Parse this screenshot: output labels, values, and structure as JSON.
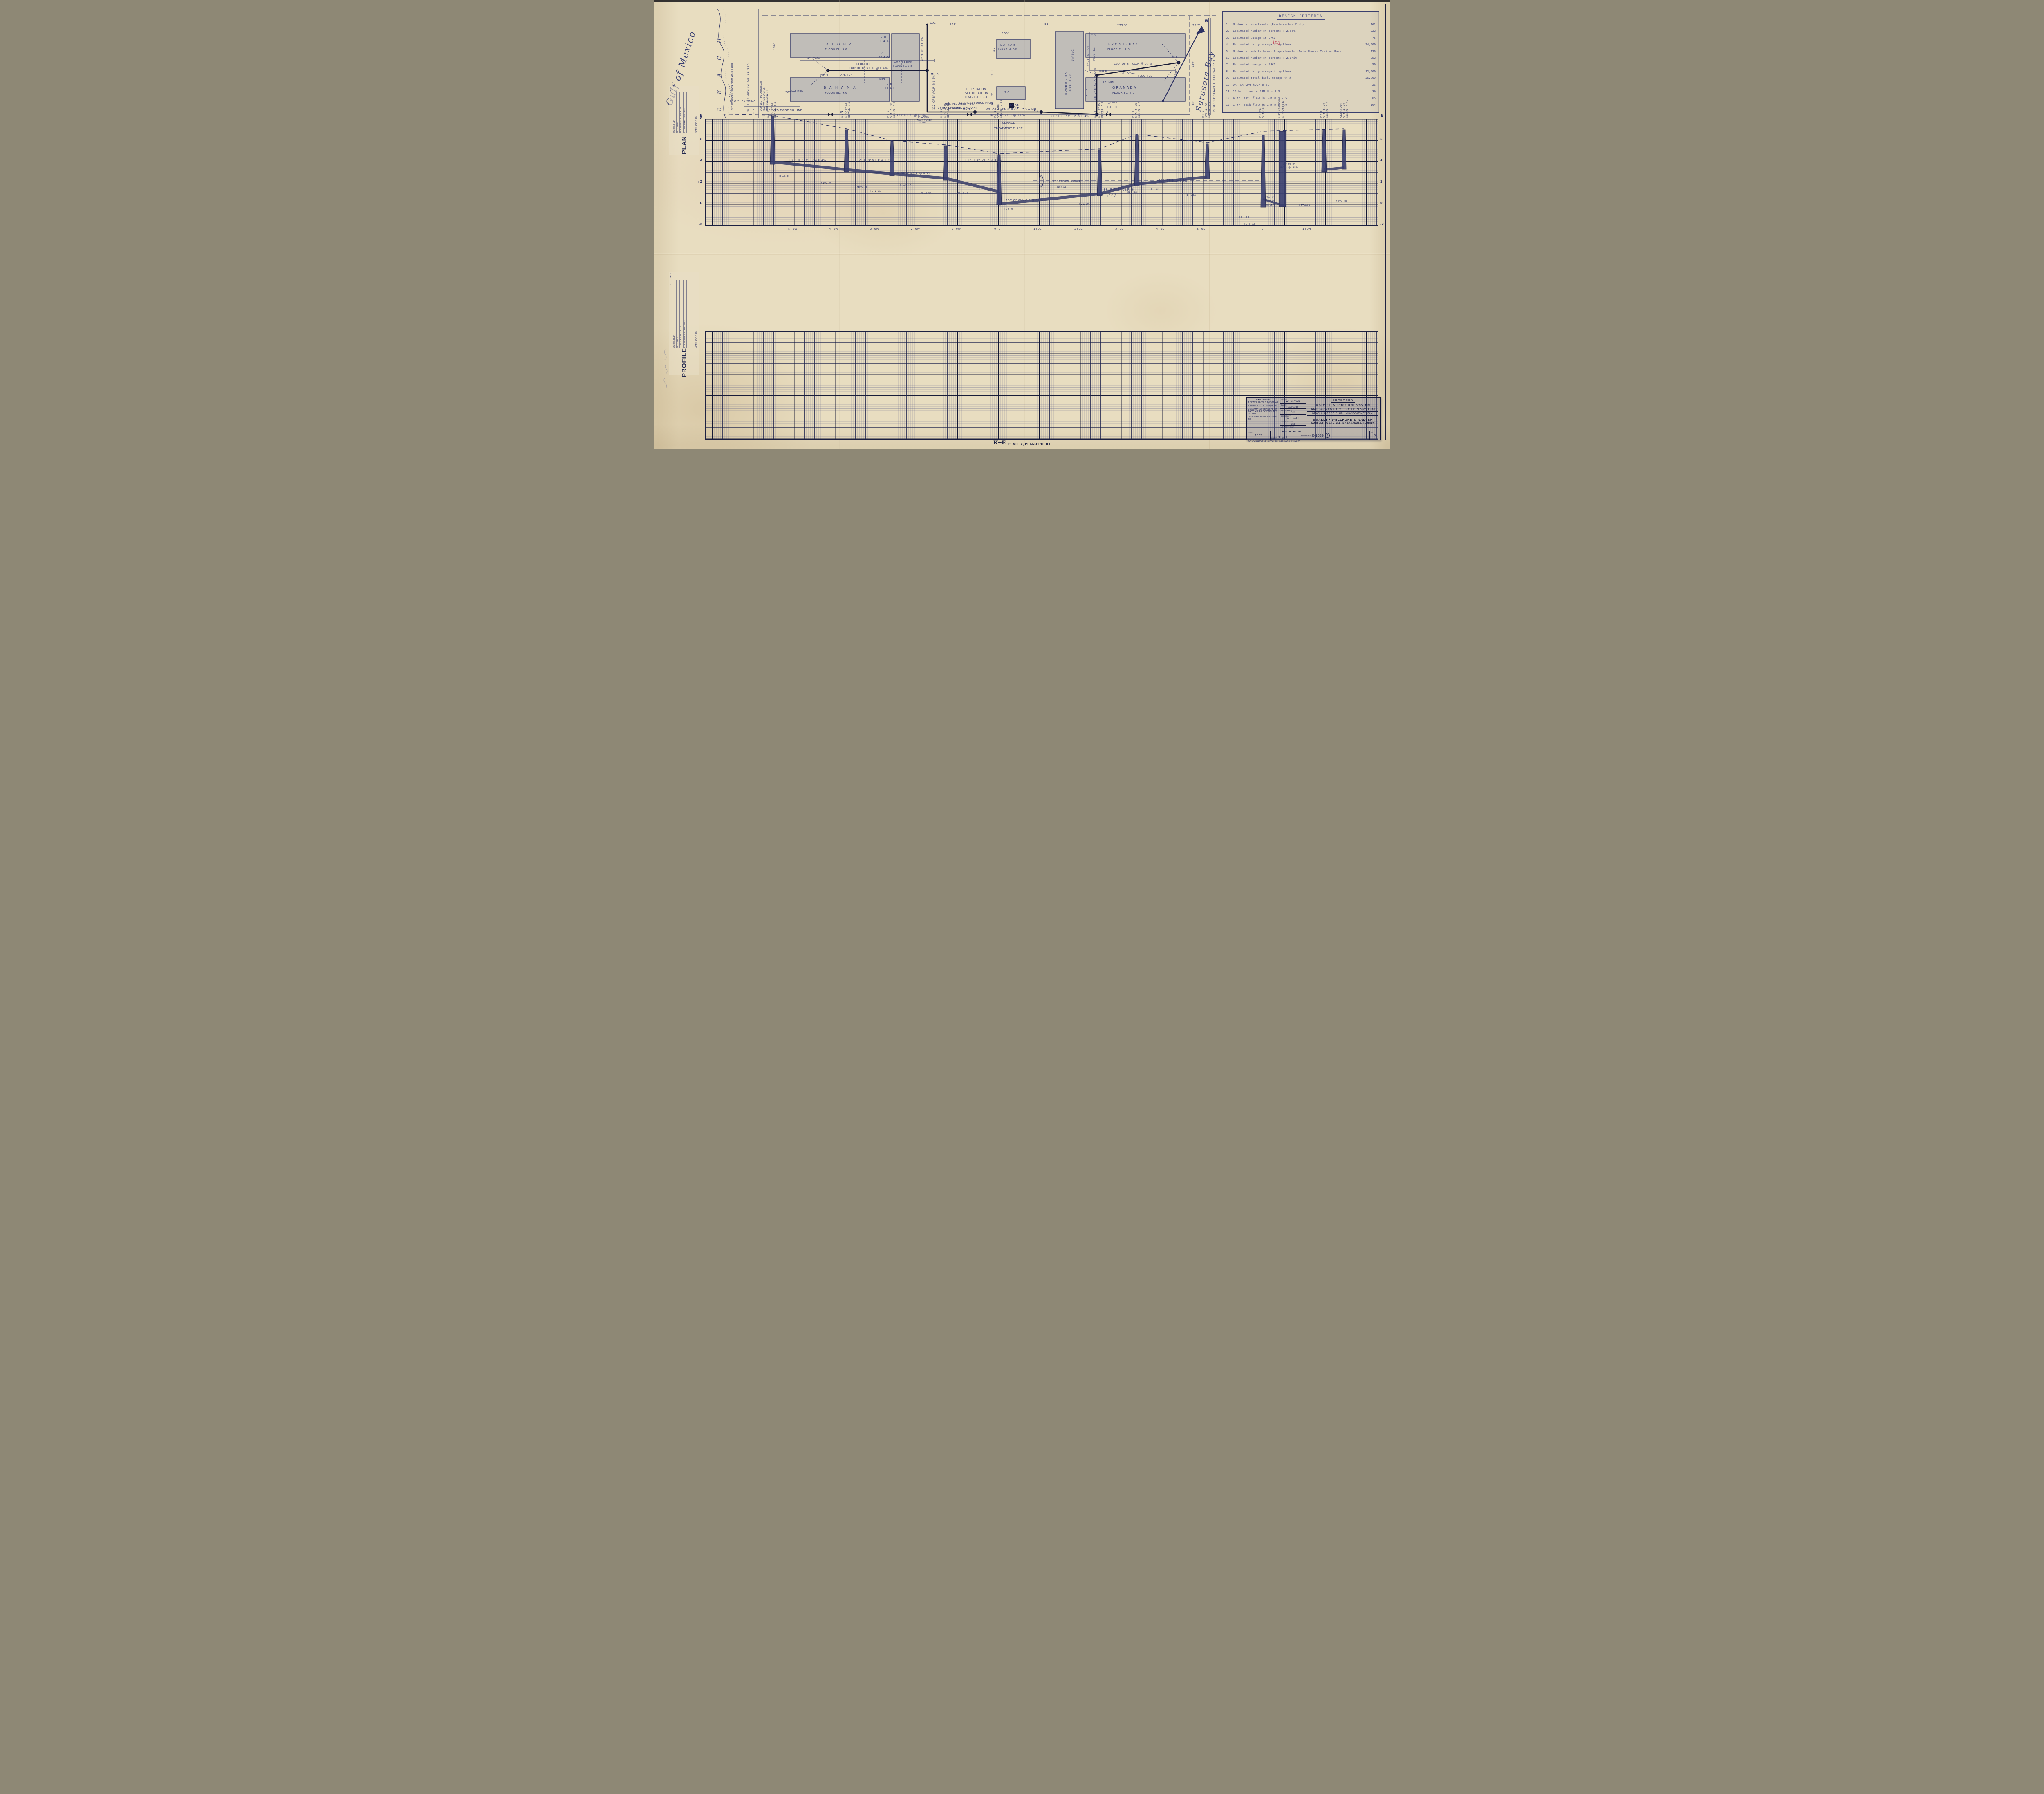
{
  "criteria": {
    "title": "DESIGN CRITERIA",
    "items": [
      {
        "no": "1.",
        "label": "Number of apartments (Beach-Harbor Club)",
        "dash": "—",
        "value": "161"
      },
      {
        "no": "2.",
        "label": "Estimated number of persons @ 2/apt.",
        "dash": "—",
        "value": "322"
      },
      {
        "no": "3.",
        "label": "Estimated useage in GPCD",
        "dash": "—",
        "value": "75"
      },
      {
        "no": "4.",
        "label": "Estimated daily useage in gallons",
        "dash": "—",
        "value": "24,200"
      },
      {
        "no": "5.",
        "label": "Number of mobile homes & apartments (Twin Shores Trailer Park)",
        "dash": "—",
        "value": "126"
      },
      {
        "no": "6.",
        "label": "Estimated number of persons @ 2/unit",
        "value": "252"
      },
      {
        "no": "7.",
        "label": "Estimated useage in GPCD",
        "value": "50"
      },
      {
        "no": "8.",
        "label": "Estimated daily useage in gallons",
        "value": "12,600"
      },
      {
        "no": "9.",
        "label": "Estimated total daily useage ④+⑧",
        "value": "36,800"
      },
      {
        "no": "10.",
        "label": "DAF in GPM ⑧/24 x 60",
        "value": "26"
      },
      {
        "no": "11.",
        "label": "16 hr. flow in GPM ⑩ x 1.5",
        "value": "39"
      },
      {
        "no": "12.",
        "label": "4 hr. max. flow in GPM ⑩ x 2.5",
        "value": "65"
      },
      {
        "no": "13.",
        "label": "1 hr. peak flow in GPM ⑩ x 4.0",
        "value": "104"
      }
    ],
    "red_note": "108"
  },
  "plan": {
    "labels": {
      "gulf": "Gulf of Mexico",
      "beach": "B E A C H",
      "hwl": "APPROXIMATE MEAN HIGH WATER LINE",
      "road_cl": "GULF OF MEXICO DR.   SR 780",
      "connect1": "CONNECT TO LONGBOAT",
      "connect2": "KEY WATER SYSTEM",
      "connect3": "WHEN AVAILABLE",
      "gs2": "2\" G.S. EXISTING",
      "tie": "TIE INTO EXISTING LINE",
      "d30": "30'",
      "d19": "19.5'",
      "d150w": "150'",
      "d226": "226.17'",
      "d44": "44'",
      "d153": "153'",
      "d88": "88'",
      "d100": "100'",
      "d50": "50'",
      "d71": "71.17",
      "d20": "20'",
      "d9": "9'",
      "d279": "279.5'",
      "d25": "25.5'",
      "d150e": "150'",
      "d45": "45'",
      "aloha": "A L O H A",
      "aloha_fl": "FLOOR EL. 9.0",
      "bahama": "B A H A M A",
      "bahama_fl": "FLOOR EL. 9.0",
      "carib": "CARIBBEAN",
      "carib_fl": "FLOOR EL. 7.5",
      "dakar": "DA KAR",
      "dakar_fl": "FLOOR EL 7.0",
      "edge": "EDGEWATER",
      "edge_fl": "FLOOR EL 7.0",
      "front": "FRONTENAC",
      "front_fl": "FLOOR EL. 7.0",
      "gran": "GRANADA",
      "gran_fl": "FLOOR EL. 7.0",
      "small70": "7.0",
      "pvc3a": "3\" P.V.C.",
      "mh4": "MH 4",
      "plugtee1": "PLUG TEE",
      "seg180": "180' OF 8\" V.C.P. @ 0.4%",
      "mh3": "MH 3",
      "co1": "C.O.",
      "seg50co": "50' OF 8\" @ 0.4%",
      "seg112": "112' OF 8\" V.C.P. @ 0.3%",
      "red32": "3X2 RED.",
      "ac6a": "6\" A.C.",
      "min7a": "7'±",
      "fe412": "FE 4.12",
      "min7b": "7'±",
      "fe406": "FE 4.06",
      "minlbl": "MIN.",
      "min7c": "7'±",
      "fe410": "FE 4.10",
      "lift1": "LIFT STATION",
      "lift2": "SEE DETAIL ON",
      "lift3": "DWG E-1039-10",
      "fm65": "65' OF 3\" FORCE MAIN",
      "reducer": "(1) 4\"X3\" REDUCER",
      "mh1a": "MH 1A",
      "fm65b": "65' OF 4\" F.M.",
      "mh1": "MH 1",
      "seg130b": "130' OF 8\" V.C.P @ 1.0%",
      "seg130a": "130' OF 8\" @ 0.3%",
      "pvc15": "1½\" PVC",
      "vc6": "6\" V.C. @ 1.5%",
      "co2": "C.O.",
      "tee_plug1": "TEE, PLUGGED FOR",
      "tee_plug2": "FUTURE FIRE HYDRANT",
      "acor": "AC OR",
      "pvc4": "4\" P.V.C.",
      "seg250": "250' OF 8\" V.C.P. @ 0.4%",
      "mh5": "MH 5",
      "tee6": "6\" TEE",
      "future": "FUTURE",
      "mh6": "MH 6",
      "seg88": "88' OF 8\" C.I.P. @ 0.4%",
      "ci4": "4\" C.I.",
      "min10": "10' MIN.",
      "pvc3b": "3\" P.V.C.",
      "plugtee2": "PLUG TEE",
      "mh7": "MH 7",
      "seg150": "150' OF 8\" V.C.P. @ 0.4%",
      "plugtee3": "PLUG TEE",
      "pvc3c": "3\" P.V.C.",
      "seawall": "PROPOSED SEAWALL @ ELEVATION 4.0",
      "sarasota": "Sarasota Bay",
      "scale50": "1\"=50'",
      "north": "N"
    }
  },
  "profile": {
    "match_left": "B",
    "match_right": "B",
    "left_axis": [
      "8",
      "6",
      "4",
      "+2",
      "0",
      "-2"
    ],
    "right_axis": [
      "6",
      "4",
      "2",
      "0",
      "-2"
    ],
    "stations": [
      "5+0W",
      "4+0W",
      "3+0W",
      "2+0W",
      "1+0W",
      "0+0",
      "1+0E",
      "2+0E",
      "3+0E",
      "4+0E",
      "5+0E",
      "0",
      "1+0N"
    ],
    "manholes": [
      {
        "id": "MH 4",
        "sta": "STA. 5+52",
        "rim": "RIM EL. 8.3"
      },
      {
        "id": "MH 3",
        "sta": "STA. 3+72",
        "rim": "RIM EL. 7.0"
      },
      {
        "id": "MH 2",
        "sta": "STA. 2+60",
        "rim": "RIM EL. 5.9"
      },
      {
        "id": "MH 1A",
        "sta": "STA. 1+30",
        "rim": "RIM EL. 5.5"
      },
      {
        "id": "MH 1",
        "sta": "STA. 0.00",
        "rim": "RIM EL. 4.65"
      },
      {
        "id": "MH 5",
        "sta": "STA. 2+50 E",
        "rim": "RIM EL. 5.1"
      },
      {
        "id": "MH 6",
        "sta": "STA. 3+38",
        "rim": "RIM EL. 6.5"
      },
      {
        "id": "MH 7",
        "sta": "STA. 4+88",
        "rim": "RIM EL. 5.7"
      },
      {
        "id": "MH #1",
        "sta": "STA 0+00",
        "rim": ""
      },
      {
        "id": "LIFT STATION",
        "sta": "STA 0+50 N",
        "rim": ""
      },
      {
        "id": "MH 3",
        "sta": "STA. 3+72",
        "rim": "RIM EL. 7.0"
      },
      {
        "id": "CLEANOUT",
        "sta": "STA. 4+22",
        "rim": "RIM EL. 7.0±"
      }
    ],
    "segments": {
      "s180": "180' OF 8\" V.C.P @ 0.4%",
      "s112": "112' OF 8\" V.C.P @ 0.3%",
      "s130a": "130' OF 8\" V.C.P. @ 0.3%",
      "s130b": "130' OF 8\" V.C.P. @ 1.0%",
      "s250": "250' OF 8\" V.C.P. @ 0.4%",
      "s88a": "88 LF OF 8\" C.I.P. @",
      "s88b": "0.4%",
      "s150": "150' OF 8\" @ 0.4%",
      "storm": "10\" STORM SEWER",
      "s50a": "50 LF.",
      "s50b": "8\"VCP",
      "s50c": "@ .8%",
      "pcp1": "50' OF 8\"",
      "pcp2": "P.C.P. @ .85%"
    },
    "inverts": {
      "fe402": "FE=4.02",
      "fe330": "FE=3.30",
      "fe328": "FE=3.28",
      "fe291": "FE=2.91",
      "fe287": "FE=2.87",
      "fe250": "FE=2.50",
      "fe247": "FE=2.47",
      "fe114": "FE 1.14",
      "fe000": "FE 0.00",
      "fe100": "FE 1.00",
      "fe151": "FE 1.51",
      "fe186": "FE 1.86",
      "fe196": "FE 1.96",
      "fe256": "FE=2.56",
      "fe205": "FE 2.05",
      "feneg": "FE(-)0.1",
      "fepos": "FE(+)0.5",
      "fe328n": "FE=3.28",
      "fe348n": "FE=3.48"
    },
    "stp1": "SEWAGE",
    "stp2": "TREATMENT PLANT",
    "wp1": "3\" WATER",
    "wp2": "FROM WATER",
    "wp3": "PLANT"
  },
  "margin": {
    "plan": {
      "title": "PLAN",
      "by": "BY",
      "date": "DATE",
      "rows": [
        "SURVEYED",
        "PLOTTED",
        "ALIGNMENT CHECKED",
        "RT. OF WAY CHECKED"
      ],
      "notebook": "NOTE BOOK",
      "no": "NO."
    },
    "profile": {
      "title": "PROFILE",
      "by": "BY",
      "date": "DATE",
      "rows": [
        "SURVEYED",
        "PLOTTED",
        "GRADES CHECKED",
        "STRUCTURES CHECKED"
      ],
      "notebook": "NOTE BOOK",
      "no": "NO."
    }
  },
  "title_block": {
    "revisions_title": "REVISIONS",
    "rev_a": "A  SEWER PROFILE 7/11/68 WR",
    "rev_b": "B  SEWERS & L.S. 7/23/68 WR",
    "rev_c": "C  ADD MH 1A, REVISE FE MH 1A TO MH 4 & EXTEND LINES 8-23-68",
    "rev_d": "D  REVISED WATER LINES 9-6-68",
    "note": "TO CONFORM WITH PLUMBING LAYOUT",
    "scale_label": "SCALE",
    "scale": "AS SHOWN",
    "date_label": "DATE",
    "date": "4-25-68",
    "designed_label": "DESIGNED BY",
    "designed": "DSC",
    "drawn_label": "DRAWN BY",
    "drawn": "W.R. & A.J.",
    "checked_label": "CHECKED BY",
    "checked": "DSC",
    "approved_label": "APPROVED BY",
    "t_proposed": "PROPOSED",
    "t_line1": "WATER DISTRIBUTION SYSTEM",
    "t_line2": "AND SEWAGE COLLECTION SYSTEM",
    "t_line3": "BEACH-HARBOR CLUB, LONGBOAT KEY, FLA.",
    "firm": "SMALLY • WELLFORD & NALVEN",
    "firm2": "CONSULTING ENGINEERS • SARASOTA, FLORIDA",
    "job_label": "JOB NO.",
    "job": "1039",
    "sheet_label": "SHEET",
    "of_label": "OF",
    "sheet": "1",
    "of": "1",
    "dwg_label": "DRAWING NO.",
    "dwg": "E-1039",
    "dwg_circle": "9",
    "rev_label": "REV.",
    "rev": "D"
  },
  "footer": {
    "ke": "K+E",
    "plate": "PLATE 2, PLAN-PROFILE",
    "co": "KEUFFEL & ESSER CO."
  }
}
